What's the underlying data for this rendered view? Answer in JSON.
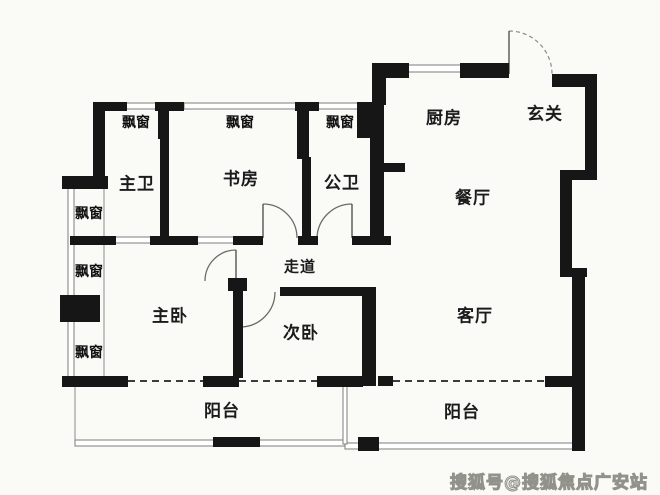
{
  "labels": {
    "master_bath": "主卫",
    "study": "书房",
    "guest_bath": "公卫",
    "kitchen": "厨房",
    "foyer": "玄关",
    "dining": "餐厅",
    "corridor": "走道",
    "master_bedroom": "主卧",
    "second_bedroom": "次卧",
    "living_room": "客厅",
    "balcony": "阳台",
    "bay_window": "飘窗"
  },
  "watermark": "搜狐号@搜狐焦点广安站",
  "colors": {
    "background": "#fafaf7",
    "wall": "#161616",
    "thin_line": "#7c7c78",
    "text": "#1b1b1b",
    "watermark_fill": "#ececea",
    "watermark_stroke": "#92928b"
  }
}
